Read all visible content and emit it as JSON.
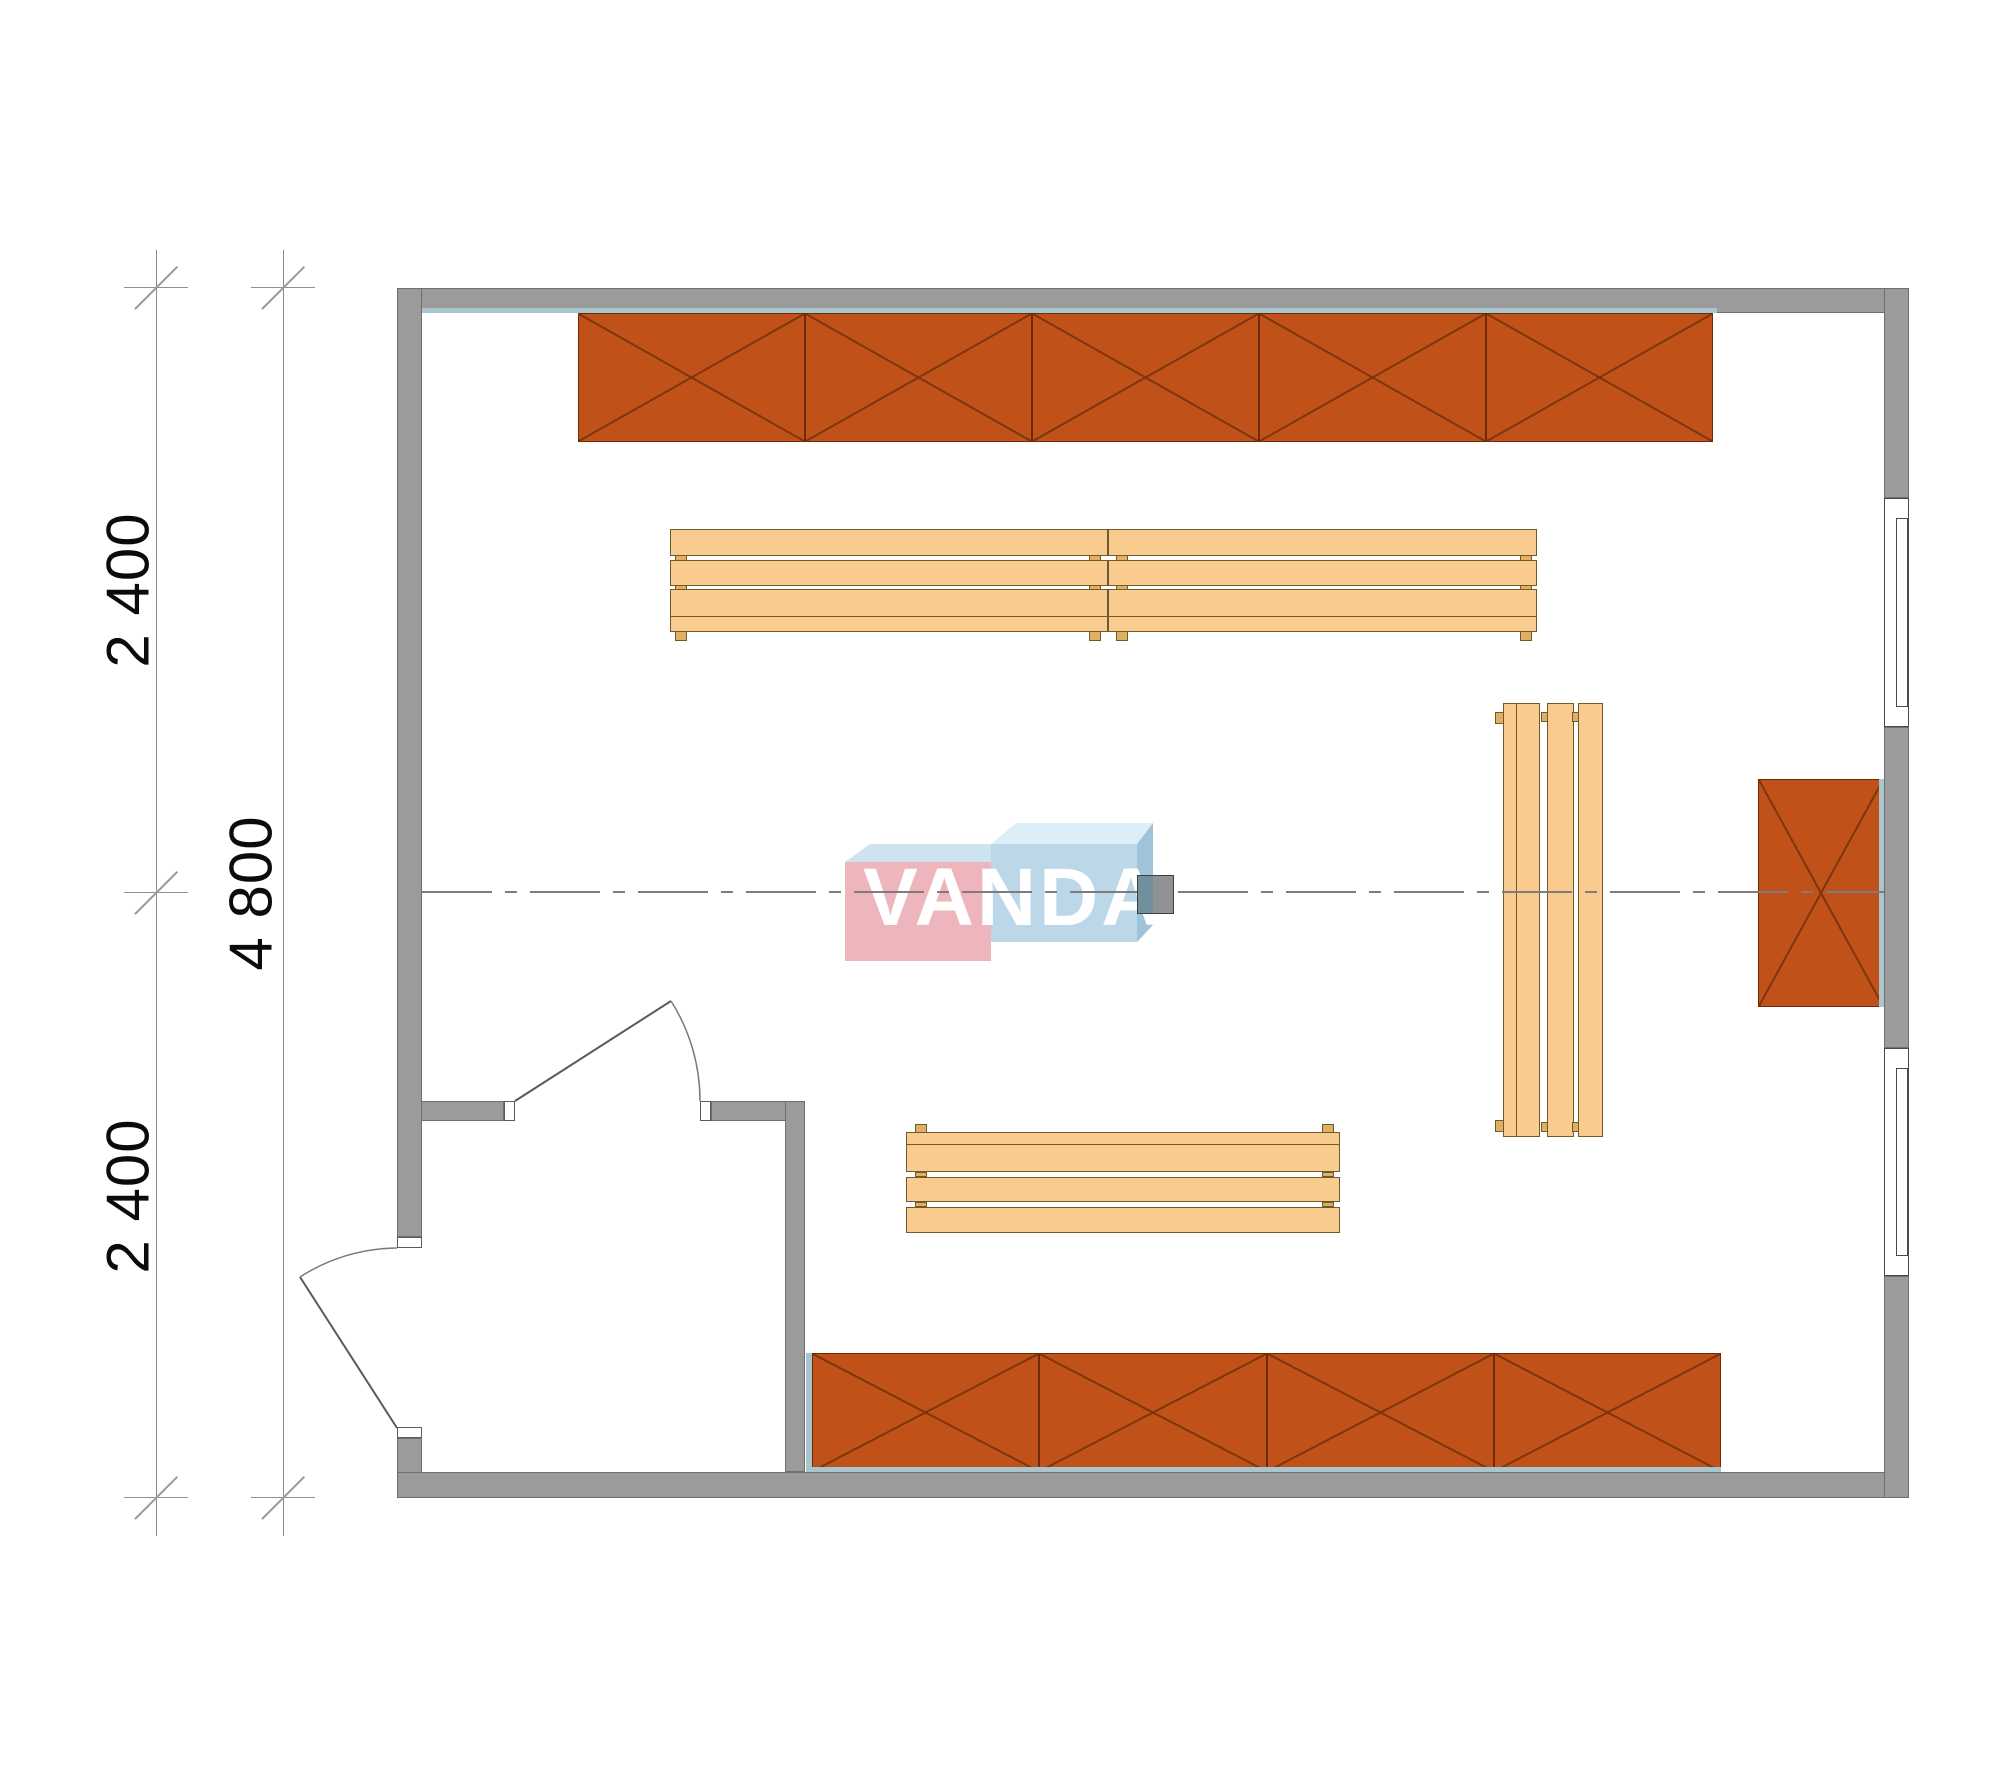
{
  "drawing": {
    "type": "floor-plan",
    "watermark": {
      "text": "VANDA"
    },
    "dimensions": {
      "inner_line_segments": [
        {
          "label": "2 400"
        },
        {
          "label": "2 400"
        }
      ],
      "outer_line_total": {
        "label": "4 800"
      }
    },
    "colors": {
      "wall": "#9b9b9b",
      "cabinet": "#c05118",
      "cabinet_line": "#7d350d",
      "bench": "#f9cb8e",
      "accent_blue": "#a9c6cf",
      "logo_pink": "#efb5bd",
      "logo_blue": "#bcd7e8",
      "dimension_text": "#0b0b0b"
    }
  },
  "plan": {
    "cabinet_rows": [
      {
        "name": "top-cabinet-row",
        "x": 578,
        "y": 313,
        "module_w": 227,
        "modules": 5,
        "h": 129
      },
      {
        "name": "bottom-cabinet-row",
        "x": 812,
        "y": 1353,
        "module_w": 227.25,
        "modules": 4,
        "h": 119
      },
      {
        "name": "right-wall-cabinet",
        "x": 1758,
        "y": 779,
        "module_w": 126,
        "modules": 1,
        "h": 228
      }
    ],
    "benches": [
      {
        "name": "bench-upper-left",
        "x": 670,
        "y": 529,
        "w": 438,
        "h": 113,
        "slats": [
          {
            "x": 0,
            "y": 0,
            "w": 438,
            "h": 27
          },
          {
            "x": 0,
            "y": 31,
            "w": 438,
            "h": 26
          },
          {
            "x": 0,
            "y": 60,
            "w": 438,
            "h": 28
          },
          {
            "x": 0,
            "y": 87,
            "w": 438,
            "h": 16
          }
        ],
        "feet": [
          {
            "x": 5,
            "y": 26,
            "w": 12,
            "h": 6
          },
          {
            "x": 419,
            "y": 26,
            "w": 12,
            "h": 6
          },
          {
            "x": 5,
            "y": 56,
            "w": 12,
            "h": 5
          },
          {
            "x": 419,
            "y": 56,
            "w": 12,
            "h": 5
          },
          {
            "x": 5,
            "y": 102,
            "w": 12,
            "h": 10
          },
          {
            "x": 419,
            "y": 102,
            "w": 12,
            "h": 10
          }
        ]
      },
      {
        "name": "bench-upper-right",
        "x": 1108,
        "y": 529,
        "w": 429,
        "h": 113,
        "slats": [
          {
            "x": 0,
            "y": 0,
            "w": 429,
            "h": 27
          },
          {
            "x": 0,
            "y": 31,
            "w": 429,
            "h": 26
          },
          {
            "x": 0,
            "y": 60,
            "w": 429,
            "h": 28
          },
          {
            "x": 0,
            "y": 87,
            "w": 429,
            "h": 16
          }
        ],
        "feet": [
          {
            "x": 8,
            "y": 26,
            "w": 12,
            "h": 6
          },
          {
            "x": 412,
            "y": 26,
            "w": 12,
            "h": 6
          },
          {
            "x": 8,
            "y": 56,
            "w": 12,
            "h": 5
          },
          {
            "x": 412,
            "y": 56,
            "w": 12,
            "h": 5
          },
          {
            "x": 8,
            "y": 102,
            "w": 12,
            "h": 10
          },
          {
            "x": 412,
            "y": 102,
            "w": 12,
            "h": 10
          }
        ]
      },
      {
        "name": "bench-lower",
        "x": 906,
        "y": 1124,
        "w": 434,
        "h": 109,
        "slats": [
          {
            "x": 0,
            "y": 8,
            "w": 434,
            "h": 13
          },
          {
            "x": 0,
            "y": 20,
            "w": 434,
            "h": 28
          },
          {
            "x": 0,
            "y": 53,
            "w": 434,
            "h": 25
          },
          {
            "x": 0,
            "y": 83,
            "w": 434,
            "h": 26
          }
        ],
        "feet": [
          {
            "x": 9,
            "y": 0,
            "w": 12,
            "h": 9
          },
          {
            "x": 416,
            "y": 0,
            "w": 12,
            "h": 9
          },
          {
            "x": 9,
            "y": 48,
            "w": 12,
            "h": 5
          },
          {
            "x": 416,
            "y": 48,
            "w": 12,
            "h": 5
          },
          {
            "x": 9,
            "y": 78,
            "w": 12,
            "h": 5
          },
          {
            "x": 416,
            "y": 78,
            "w": 12,
            "h": 5
          }
        ]
      },
      {
        "name": "bench-vertical",
        "x": 1495,
        "y": 703,
        "w": 108,
        "h": 434,
        "slats": [
          {
            "x": 8,
            "y": 0,
            "w": 14,
            "h": 434
          },
          {
            "x": 21,
            "y": 0,
            "w": 24,
            "h": 434
          },
          {
            "x": 52,
            "y": 0,
            "w": 27,
            "h": 434
          },
          {
            "x": 83,
            "y": 0,
            "w": 25,
            "h": 434
          }
        ],
        "feet": [
          {
            "x": 0,
            "y": 9,
            "w": 9,
            "h": 12
          },
          {
            "x": 46,
            "y": 9,
            "w": 7,
            "h": 10
          },
          {
            "x": 77,
            "y": 9,
            "w": 7,
            "h": 10
          },
          {
            "x": 0,
            "y": 417,
            "w": 9,
            "h": 12
          },
          {
            "x": 46,
            "y": 419,
            "w": 7,
            "h": 10
          },
          {
            "x": 77,
            "y": 419,
            "w": 7,
            "h": 10
          }
        ]
      }
    ]
  }
}
